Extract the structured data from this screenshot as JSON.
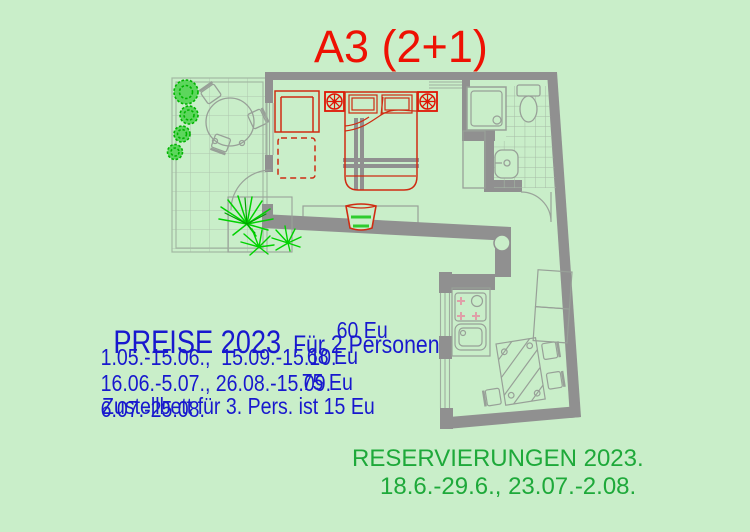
{
  "title": "A3 (2+1)",
  "prices": {
    "heading": "PREISE 2023",
    "subheading": "Für 2 Personen",
    "rows": [
      {
        "dates": "1.05.-15.06.,  15.09.-15.10.",
        "price": "60 Eu"
      },
      {
        "dates": "16.06.-5.07., 26.08.-15.09.",
        "price": "68 Eu"
      },
      {
        "dates": "6.07.-25.08.",
        "price": "75 Eu"
      }
    ],
    "note": "Zustellbett für 3. Pers. ist 15 Eu"
  },
  "reservations": {
    "heading": "RESERVIERUNGEN 2023.",
    "dates": "18.6.-29.6., 23.07.-2.08."
  },
  "colors": {
    "background": "#c9eec9",
    "wall_gray": "#909090",
    "furniture_red": "#cf2b12",
    "title_red": "#ee1103",
    "price_blue": "#1818ce",
    "reservation_green": "#1ea93a",
    "plant_green": "#00d200",
    "fixture_gray": "#98a098"
  },
  "plan_symbols": [
    "ceiling-fan-icon",
    "double-bed-icon",
    "sofa-icon",
    "shower-icon",
    "toilet-icon",
    "sink-icon",
    "stove-icon",
    "dining-table-icon",
    "palm-plant-icon",
    "bush-icon"
  ]
}
